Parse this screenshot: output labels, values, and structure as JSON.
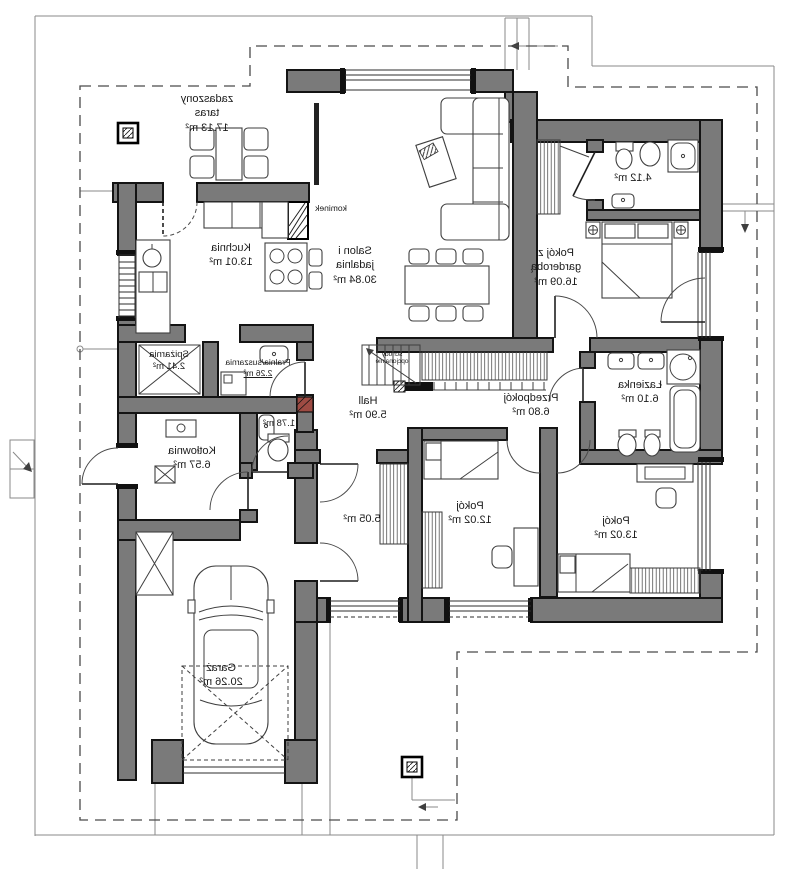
{
  "colors": {
    "wall": "#7a7a7a",
    "line": "#3a3a3a",
    "dash": "#4a4a4a",
    "accent": "#9e4b43"
  },
  "rooms": [
    {
      "id": "taras",
      "name": "zadaszony\ntaras",
      "area": "17.13 m²"
    },
    {
      "id": "kuchnia",
      "name": "Kuchnia",
      "area": "13.01 m²"
    },
    {
      "id": "salon",
      "name": "Salon i\njadalnia",
      "area": "30.84 m²"
    },
    {
      "id": "pokoj-g",
      "name": "Pokój z\ngarderobą",
      "area": "16.09 m²"
    },
    {
      "id": "lazienka-m",
      "name": "",
      "area": "4.12 m²"
    },
    {
      "id": "lazienka",
      "name": "Łazienka",
      "area": "6.10 m²"
    },
    {
      "id": "przedpokoj",
      "name": "Przedpokój",
      "area": "6.80 m²"
    },
    {
      "id": "hall",
      "name": "Hall",
      "area": "5.90 m²"
    },
    {
      "id": "spizarnia",
      "name": "Spiżarnia",
      "area": "2.41 m²"
    },
    {
      "id": "pralnia",
      "name": "Pralnia/suszarnia",
      "area": "2.26 m²"
    },
    {
      "id": "wc",
      "name": "",
      "area": "1.78 m²"
    },
    {
      "id": "kotlownia",
      "name": "Kotłownia",
      "area": "6.57 m²"
    },
    {
      "id": "korytarz",
      "name": "",
      "area": "5.05 m²"
    },
    {
      "id": "pokoj-12",
      "name": "Pokój",
      "area": "12.02 m²"
    },
    {
      "id": "pokoj-13",
      "name": "Pokój",
      "area": "13.02 m²"
    },
    {
      "id": "garaz",
      "name": "Garaż",
      "area": "20.26 m²"
    }
  ],
  "annotations": {
    "fireplace": "kominek",
    "optional_stairs": "schody\nopcjonalnie"
  }
}
